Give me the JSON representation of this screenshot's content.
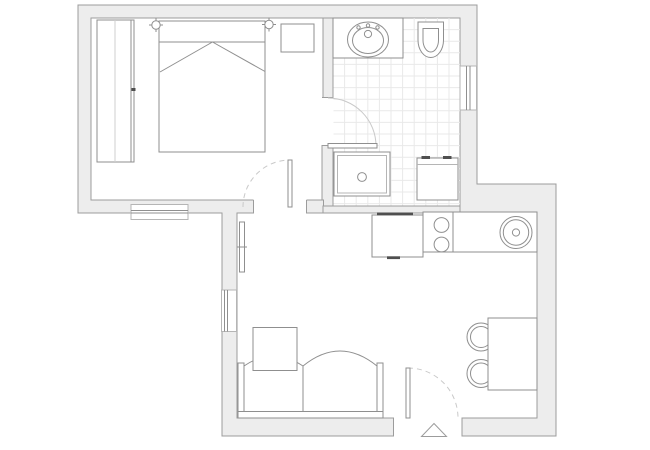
{
  "canvas": {
    "width": 650,
    "height": 450,
    "background": "#ffffff"
  },
  "palette": {
    "wall_fill": "#ededed",
    "wall_stroke": "#9c9c9c",
    "floor": "#ffffff",
    "line": "#8f8f8f",
    "frame": "#b5b5b5",
    "light": "#c9c9c9",
    "tile": "#e9e9e9",
    "dark": "#4f4f4f",
    "faint": "#cfcfcf"
  },
  "plan": {
    "shapes": [
      {
        "name": "apartment-outer-wall",
        "kind": "polygon",
        "points": "78,5 477,5 477,184 556,184 556,436 222,436 222,213 78,213",
        "fill": "$wall_fill",
        "stroke": "$wall_stroke"
      },
      {
        "name": "bedroom-floor",
        "kind": "rect",
        "x": 91,
        "y": 18,
        "w": 232,
        "h": 182,
        "fill": "$floor",
        "stroke": "$wall_stroke"
      },
      {
        "name": "bathroom-floor",
        "kind": "rect",
        "x": 333,
        "y": 18,
        "w": 127,
        "h": 188,
        "fill": "$floor",
        "stroke": "$wall_stroke"
      },
      {
        "name": "living-room-floor",
        "kind": "rect",
        "x": 237,
        "y": 213,
        "w": 300,
        "h": 205,
        "fill": "$floor",
        "stroke": "$wall_stroke"
      },
      {
        "name": "bathroom-tile-grid",
        "kind": "grid",
        "x": 333,
        "y": 18,
        "w": 127,
        "h": 188,
        "step": 11.6,
        "stroke": "$tile"
      },
      {
        "name": "wall-divider-upper",
        "kind": "rect",
        "x": 323,
        "y": 18,
        "w": 10,
        "h": 79.5,
        "fill": "$wall_fill",
        "stroke": "$wall_stroke"
      },
      {
        "name": "wall-divider-lower",
        "kind": "rect",
        "x": 322,
        "y": 145.5,
        "w": 11,
        "h": 60.5,
        "fill": "$wall_fill",
        "stroke": "$wall_stroke"
      },
      {
        "name": "wall-bathroom-south-left",
        "kind": "rect",
        "x": 306.5,
        "y": 200,
        "w": 17,
        "h": 13,
        "fill": "$wall_fill",
        "stroke": "$wall_stroke"
      },
      {
        "name": "wall-bathroom-south",
        "kind": "rect",
        "x": 323,
        "y": 206,
        "w": 137,
        "h": 7,
        "fill": "$wall_fill",
        "stroke": "$wall_stroke"
      },
      {
        "name": "bedroom-doorway-opening",
        "kind": "rect",
        "x": 253.5,
        "y": 199.5,
        "w": 53,
        "h": 14.5,
        "fill": "$floor"
      },
      {
        "name": "bedroom-doorway-jamb",
        "kind": "line",
        "x1": 253.5,
        "y1": 200,
        "x2": 253.5,
        "y2": 213.5,
        "stroke": "$wall_stroke"
      },
      {
        "name": "bedroom-doorway-jamb",
        "kind": "line",
        "x1": 306.5,
        "y1": 200,
        "x2": 306.5,
        "y2": 213.5,
        "stroke": "$wall_stroke"
      },
      {
        "name": "bathroom-doorway-opening",
        "kind": "rect",
        "x": 322,
        "y": 97.5,
        "w": 11.5,
        "h": 48,
        "fill": "$floor"
      },
      {
        "name": "bathroom-doorway-jamb",
        "kind": "line",
        "x1": 322,
        "y1": 97.5,
        "x2": 333.5,
        "y2": 97.5,
        "stroke": "$wall_stroke"
      },
      {
        "name": "bathroom-doorway-jamb",
        "kind": "line",
        "x1": 322,
        "y1": 145.5,
        "x2": 333.5,
        "y2": 145.5,
        "stroke": "$wall_stroke"
      },
      {
        "name": "entrance-doorway-opening",
        "kind": "rect",
        "x": 393.5,
        "y": 417,
        "w": 68.5,
        "h": 19.5,
        "fill": "$floor"
      },
      {
        "name": "entrance-doorway-jamb",
        "kind": "line",
        "x1": 393.5,
        "y1": 417.5,
        "x2": 393.5,
        "y2": 436.5,
        "stroke": "$wall_stroke"
      },
      {
        "name": "entrance-doorway-jamb",
        "kind": "line",
        "x1": 462,
        "y1": 417.5,
        "x2": 462,
        "y2": 436.5,
        "stroke": "$wall_stroke"
      },
      {
        "name": "bedroom-window",
        "kind": "rect",
        "x": 131,
        "y": 204.5,
        "w": 57,
        "h": 15,
        "fill": "$floor",
        "stroke": "$frame"
      },
      {
        "name": "bedroom-window-glass",
        "kind": "line",
        "x1": 131,
        "y1": 210.5,
        "x2": 188,
        "y2": 210.5,
        "stroke": "$line"
      },
      {
        "name": "bedroom-window-glass",
        "kind": "line",
        "x1": 131,
        "y1": 213,
        "x2": 188,
        "y2": 213,
        "stroke": "$line"
      },
      {
        "name": "living-room-window",
        "kind": "rect",
        "x": 221.5,
        "y": 290,
        "w": 15,
        "h": 41.5,
        "fill": "$floor",
        "stroke": "$frame"
      },
      {
        "name": "living-room-window-glass",
        "kind": "line",
        "x1": 224.5,
        "y1": 290,
        "x2": 224.5,
        "y2": 331.5,
        "stroke": "$line"
      },
      {
        "name": "living-room-window-glass",
        "kind": "line",
        "x1": 227.5,
        "y1": 290,
        "x2": 227.5,
        "y2": 331.5,
        "stroke": "$line"
      },
      {
        "name": "bathroom-window",
        "kind": "rect",
        "x": 460,
        "y": 66,
        "w": 16.5,
        "h": 44,
        "fill": "$floor",
        "stroke": "$frame"
      },
      {
        "name": "bathroom-window-glass",
        "kind": "line",
        "x1": 466.5,
        "y1": 66,
        "x2": 466.5,
        "y2": 110,
        "stroke": "$line"
      },
      {
        "name": "bathroom-window-glass",
        "kind": "line",
        "x1": 470,
        "y1": 66,
        "x2": 470,
        "y2": 110,
        "stroke": "$line"
      },
      {
        "name": "wardrobe",
        "kind": "rect",
        "x": 97,
        "y": 20,
        "w": 37,
        "h": 142,
        "fill": "$floor",
        "stroke": "$line"
      },
      {
        "name": "wardrobe-door-divider",
        "kind": "line",
        "x1": 115,
        "y1": 20,
        "x2": 115,
        "y2": 162,
        "stroke": "$faint"
      },
      {
        "name": "wardrobe-door-edge",
        "kind": "line",
        "x1": 131,
        "y1": 20,
        "x2": 131,
        "y2": 162,
        "stroke": "$line"
      },
      {
        "name": "wardrobe-handle",
        "kind": "rect",
        "x": 131.5,
        "y": 88,
        "w": 4,
        "h": 3,
        "fill": "$dark"
      },
      {
        "name": "bed",
        "kind": "rect",
        "x": 159,
        "y": 21,
        "w": 106,
        "h": 131,
        "fill": "$floor",
        "stroke": "$line"
      },
      {
        "name": "bed-headboard-line",
        "kind": "line",
        "x1": 159,
        "y1": 42,
        "x2": 265,
        "y2": 42,
        "stroke": "$line"
      },
      {
        "name": "bed-blanket-fold",
        "kind": "line",
        "x1": 160,
        "y1": 72,
        "x2": 212.5,
        "y2": 42,
        "stroke": "$line"
      },
      {
        "name": "bed-blanket-fold",
        "kind": "line",
        "x1": 212.5,
        "y1": 42,
        "x2": 265,
        "y2": 71.5,
        "stroke": "$line"
      },
      {
        "name": "wall-lamp-icon",
        "kind": "path",
        "d": "M149 25 H163 M156 18 V32",
        "stroke": "$line"
      },
      {
        "name": "wall-lamp-icon",
        "kind": "circle",
        "cx": 156,
        "cy": 25,
        "r": 4.2,
        "fill": "$floor",
        "stroke": "$line"
      },
      {
        "name": "wall-lamp-icon",
        "kind": "path",
        "d": "M262 24.5 H276 M269 17.5 V31.5",
        "stroke": "$line"
      },
      {
        "name": "wall-lamp-icon",
        "kind": "circle",
        "cx": 269,
        "cy": 24.5,
        "r": 4.2,
        "fill": "$floor",
        "stroke": "$line"
      },
      {
        "name": "nightstand",
        "kind": "rect",
        "x": 281,
        "y": 24,
        "w": 33,
        "h": 28,
        "fill": "$floor",
        "stroke": "$line"
      },
      {
        "name": "vanity-counter",
        "kind": "rect",
        "x": 333,
        "y": 18,
        "w": 70,
        "h": 40,
        "fill": "$floor",
        "stroke": "$line"
      },
      {
        "name": "bathroom-sink-basin",
        "kind": "ellipse",
        "cx": 368,
        "cy": 39.5,
        "rx": 20.5,
        "ry": 17.5,
        "fill": "$floor",
        "stroke": "$line"
      },
      {
        "name": "bathroom-sink-basin-inner",
        "kind": "ellipse",
        "cx": 368,
        "cy": 40.5,
        "rx": 15.5,
        "ry": 13,
        "stroke": "$line"
      },
      {
        "name": "faucet-dot",
        "kind": "circle",
        "cx": 358.5,
        "cy": 27.5,
        "r": 1.7,
        "stroke": "$line"
      },
      {
        "name": "faucet-dot",
        "kind": "circle",
        "cx": 368,
        "cy": 25.5,
        "r": 1.7,
        "stroke": "$line"
      },
      {
        "name": "faucet-dot",
        "kind": "circle",
        "cx": 377.5,
        "cy": 27.5,
        "r": 1.7,
        "stroke": "$line"
      },
      {
        "name": "faucet-base",
        "kind": "circle",
        "cx": 368,
        "cy": 34,
        "r": 3.6,
        "stroke": "$line"
      },
      {
        "name": "toilet",
        "kind": "path",
        "d": "M418 22 H443.5 V40 A12.75 17.5 0 0 1 418 40 Z",
        "fill": "$floor",
        "stroke": "$line"
      },
      {
        "name": "toilet-bowl-inner",
        "kind": "path",
        "d": "M423 28.5 H438.5 V40 A7.75 12 0 0 1 423 40 Z",
        "stroke": "$line"
      },
      {
        "name": "shower-tray",
        "kind": "rect",
        "x": 334,
        "y": 152,
        "w": 56,
        "h": 44,
        "fill": "$floor",
        "stroke": "$line"
      },
      {
        "name": "shower-tray-inner",
        "kind": "rect",
        "x": 337.5,
        "y": 155.5,
        "w": 49,
        "h": 37.5,
        "stroke": "$frame"
      },
      {
        "name": "shower-drain",
        "kind": "circle",
        "cx": 362,
        "cy": 177,
        "r": 4.4,
        "stroke": "$line"
      },
      {
        "name": "washing-machine",
        "kind": "rect",
        "x": 417,
        "y": 158,
        "w": 41,
        "h": 42,
        "fill": "$floor",
        "stroke": "$line"
      },
      {
        "name": "washing-machine-panel-line",
        "kind": "line",
        "x1": 417,
        "y1": 164.5,
        "x2": 458,
        "y2": 164.5,
        "stroke": "$frame"
      },
      {
        "name": "washing-machine-control",
        "kind": "rect",
        "x": 421.5,
        "y": 156,
        "w": 8.5,
        "h": 3,
        "fill": "$dark"
      },
      {
        "name": "washing-machine-control",
        "kind": "rect",
        "x": 443,
        "y": 156,
        "w": 8.5,
        "h": 3,
        "fill": "$dark"
      },
      {
        "name": "kitchen-counter",
        "kind": "rect",
        "x": 423,
        "y": 212,
        "w": 114,
        "h": 40,
        "fill": "$floor",
        "stroke": "$line"
      },
      {
        "name": "kitchen-counter-section-line",
        "kind": "line",
        "x1": 453,
        "y1": 212,
        "x2": 453,
        "y2": 252,
        "stroke": "$line"
      },
      {
        "name": "cooktop-burner",
        "kind": "circle",
        "cx": 441.5,
        "cy": 225,
        "r": 7.4,
        "stroke": "$line"
      },
      {
        "name": "cooktop-burner",
        "kind": "circle",
        "cx": 441.5,
        "cy": 244.5,
        "r": 7.4,
        "stroke": "$line"
      },
      {
        "name": "kitchen-sink",
        "kind": "circle",
        "cx": 516,
        "cy": 232.5,
        "r": 16,
        "fill": "$floor",
        "stroke": "$line"
      },
      {
        "name": "kitchen-sink-inner",
        "kind": "circle",
        "cx": 516,
        "cy": 232.5,
        "r": 12.7,
        "stroke": "$line"
      },
      {
        "name": "kitchen-sink-drain",
        "kind": "circle",
        "cx": 516,
        "cy": 232.5,
        "r": 3.6,
        "stroke": "$line"
      },
      {
        "name": "refrigerator",
        "kind": "rect",
        "x": 372,
        "y": 215,
        "w": 51,
        "h": 42,
        "fill": "$floor",
        "stroke": "$line"
      },
      {
        "name": "refrigerator-mark",
        "kind": "rect",
        "x": 377,
        "y": 212.5,
        "w": 36,
        "h": 2.8,
        "fill": "$dark"
      },
      {
        "name": "refrigerator-mark",
        "kind": "rect",
        "x": 387,
        "y": 256.3,
        "w": 13,
        "h": 2.8,
        "fill": "$dark"
      },
      {
        "name": "radiator",
        "kind": "rect",
        "x": 239.5,
        "y": 222,
        "w": 5,
        "h": 50,
        "fill": "$floor",
        "stroke": "$line"
      },
      {
        "name": "radiator-tick",
        "kind": "line",
        "x1": 237,
        "y1": 247,
        "x2": 247,
        "y2": 247,
        "stroke": "$line"
      },
      {
        "name": "sofa-base",
        "kind": "rect",
        "x": 238,
        "y": 411.5,
        "w": 145,
        "h": 6.5,
        "fill": "$floor",
        "stroke": "$line"
      },
      {
        "name": "sofa-armrest",
        "kind": "rect",
        "x": 238,
        "y": 363,
        "w": 6,
        "h": 48.5,
        "fill": "$floor",
        "stroke": "$line"
      },
      {
        "name": "sofa-armrest",
        "kind": "rect",
        "x": 377,
        "y": 363,
        "w": 6,
        "h": 48.5,
        "fill": "$floor",
        "stroke": "$line"
      },
      {
        "name": "sofa-cushion",
        "kind": "path",
        "d": "M244 411.5 V366 Q273 346 303 366 V411.5 Z",
        "fill": "$floor",
        "stroke": "$line"
      },
      {
        "name": "sofa-cushion",
        "kind": "path",
        "d": "M303 411.5 V366 Q340 336 377 366 V411.5 Z",
        "fill": "$floor",
        "stroke": "$line"
      },
      {
        "name": "coffee-table",
        "kind": "rect",
        "x": 253,
        "y": 327.5,
        "w": 44,
        "h": 43,
        "fill": "$floor",
        "stroke": "$line"
      },
      {
        "name": "dining-chair",
        "kind": "circle",
        "cx": 481,
        "cy": 337,
        "r": 14,
        "fill": "$floor",
        "stroke": "$line"
      },
      {
        "name": "dining-chair-inner",
        "kind": "circle",
        "cx": 481,
        "cy": 337,
        "r": 10.5,
        "stroke": "$line"
      },
      {
        "name": "dining-chair",
        "kind": "circle",
        "cx": 481,
        "cy": 373.5,
        "r": 14,
        "fill": "$floor",
        "stroke": "$line"
      },
      {
        "name": "dining-chair-inner",
        "kind": "circle",
        "cx": 481,
        "cy": 373.5,
        "r": 10.5,
        "stroke": "$line"
      },
      {
        "name": "dining-table",
        "kind": "rect",
        "x": 488,
        "y": 318,
        "w": 49,
        "h": 72,
        "fill": "$floor",
        "stroke": "$line"
      },
      {
        "name": "bathroom-door-swing-arc",
        "kind": "path",
        "d": "M328 98 A48 48 0 0 1 376 146",
        "stroke": "$light"
      },
      {
        "name": "bathroom-door-leaf",
        "kind": "rect",
        "x": 328,
        "y": 143.5,
        "w": 49,
        "h": 4.5,
        "fill": "$floor",
        "stroke": "$line"
      },
      {
        "name": "bedroom-door-swing-arc",
        "kind": "path",
        "d": "M243 207 A47 47 0 0 1 290 160",
        "stroke": "$light",
        "dash": "5,4"
      },
      {
        "name": "bedroom-door-leaf",
        "kind": "rect",
        "x": 288,
        "y": 160,
        "w": 4,
        "h": 47,
        "fill": "$floor",
        "stroke": "$line"
      },
      {
        "name": "entrance-door-swing-arc",
        "kind": "path",
        "d": "M408 368 A50 50 0 0 1 458 418",
        "stroke": "$light",
        "dash": "5,4"
      },
      {
        "name": "entrance-door-leaf",
        "kind": "rect",
        "x": 406,
        "y": 368,
        "w": 4,
        "h": 50,
        "fill": "$floor",
        "stroke": "$line"
      },
      {
        "name": "entrance-direction-triangle",
        "kind": "path",
        "d": "M434 423.5 L446.5 436.5 H421.5 Z",
        "fill": "$floor",
        "stroke": "$wall_stroke"
      }
    ]
  }
}
